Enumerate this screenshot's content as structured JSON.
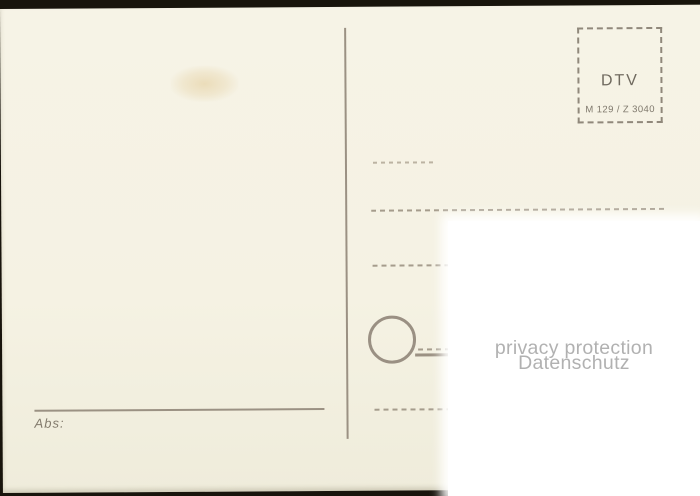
{
  "scan": {
    "stamp_box": {
      "publisher": "DTV",
      "catalog_number": "M 129 / Z 3040"
    },
    "sender_label": "Abs:",
    "watermark": {
      "line1": "privacy protection",
      "line2": "Datenschutz"
    },
    "colors": {
      "card_background": "#f5f2e3",
      "line_ink": "#9b9183",
      "dashed_ink": "#a59c8c",
      "faint_dashed_ink": "#bcb3a2",
      "stamp_ink": "#6f695e",
      "sender_ink": "#837b6d",
      "watermark_text": "#b1b1b1",
      "scan_backdrop": "#18140c",
      "privacy_overlay": "#ffffff"
    }
  }
}
